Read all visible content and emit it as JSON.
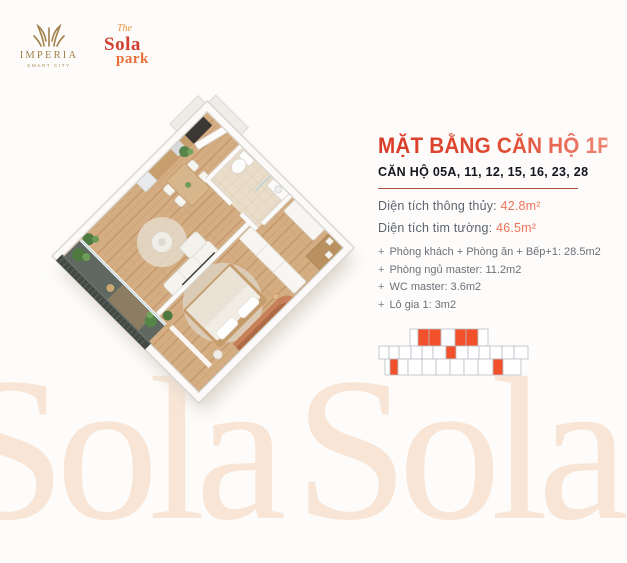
{
  "header": {
    "imperia": {
      "name": "IMPERIA",
      "sub": "SMART CITY"
    },
    "sola": {
      "the": "The",
      "sola": "Sola",
      "park": "park"
    }
  },
  "panel": {
    "title": "MẶT BẰNG CĂN HỘ 1PN+",
    "subtitle": "CĂN HỘ 05A, 11, 12, 15, 16, 23, 28",
    "areas": [
      {
        "label": "Diện tích thông thủy:",
        "value": "42.8m²"
      },
      {
        "label": "Diện tích tim tường:",
        "value": "46.5m²"
      }
    ],
    "bullet": "+",
    "rooms": [
      "Phòng khách + Phòng ăn + Bếp+1: 28.5m2",
      "Phòng ngủ master: 11.2m2",
      "WC master: 3.6m2",
      "Lô gia 1: 3m2"
    ]
  },
  "watermark": {
    "text": "Sola"
  },
  "colors": {
    "brand_red": "#dc4530",
    "accent_coral": "#f0735a",
    "divider_red": "#a8543c",
    "gold": "#a1804a",
    "dark_text": "#15151e",
    "gray_text": "#6b7179",
    "keyplan_highlight": "#f2512b",
    "background": "#fdfcfa"
  }
}
